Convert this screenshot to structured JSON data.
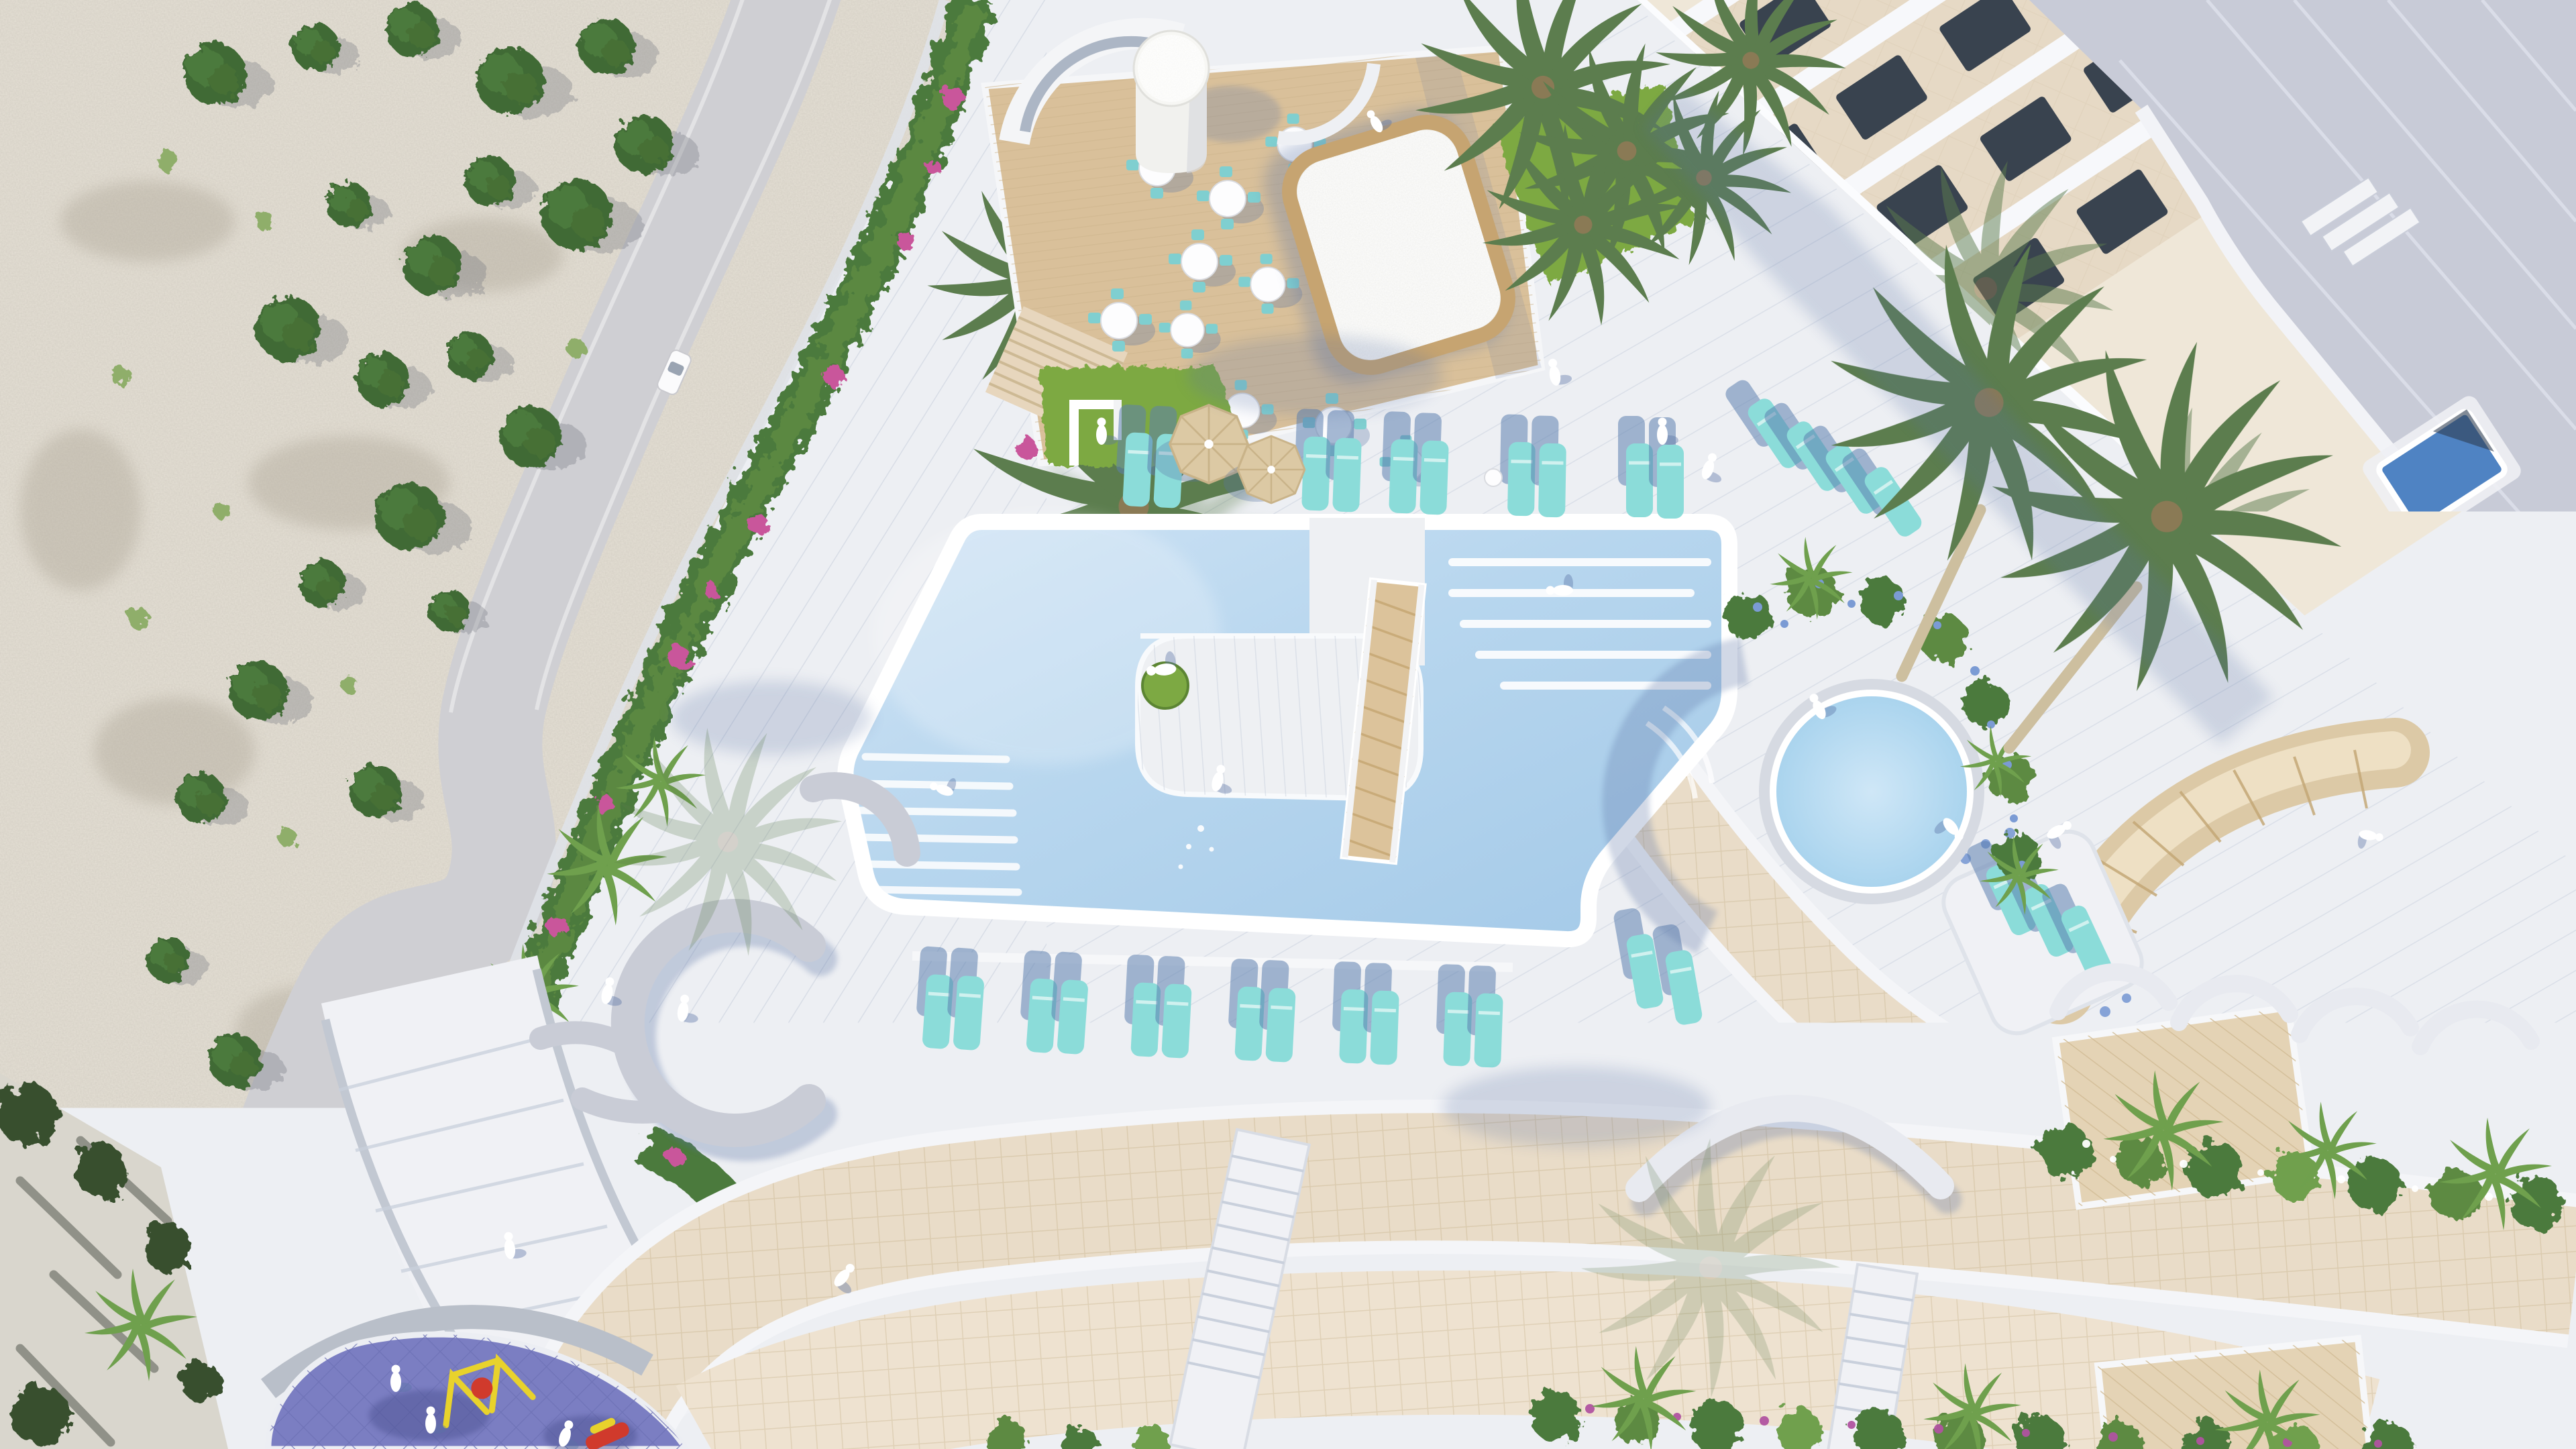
{
  "meta": {
    "title": "Top-down aerial architectural rendering of a seaside resort pool deck with cliff road, restaurant terrace, curved apartment building and playground",
    "view": "top-down aerial",
    "render_style": "architectural visualization, white Mediterranean style"
  },
  "palette": {
    "deck": "#edeff3",
    "deckStripe": "#c7cedc",
    "poolWater": "#b7d6ee",
    "poolDeep": "#a5cbe9",
    "roundPool": "#b9dcf2",
    "lounger": "#8bdcd9",
    "umbrella": "#dcc9a4",
    "wood": "#d9c09a",
    "woodDark": "#c6a471",
    "pavRoof": "#efefec",
    "grass": "#7da943",
    "tree": "#3f6b34",
    "treeLight": "#5d8a42",
    "palm": "#5c7d4e",
    "boug": "#c9579b",
    "blueFlower": "#7b9bd4",
    "rock": "#e5e0d5",
    "road": "#cfcfd3",
    "floor": "#e6d9c5",
    "window": "#39434f",
    "railing": "#f7f8fb",
    "roof": "#c8cbd7",
    "roofPool": "#4f83c3",
    "tan": "#e9dcc8",
    "tanLight": "#eee2d0",
    "playground": "#7b7ec2",
    "shore": "#6b6f66",
    "shadow": "#5a73a5",
    "people": "#ffffff",
    "bench": "#c9ccd6"
  },
  "labels": {
    "scene": "Aerial resort pool deck rendering",
    "cliff": "Rocky cliff hillside with round shrubs",
    "road": "Winding access road on the cliff",
    "car": "White car on the road",
    "hedge": "Landscaped hedge with bougainvillea along the deck edge",
    "terrace": "Restaurant terrace with round white tables and turquoise chairs",
    "pavilion": "Pool-bar pavilion with timber-edged roof",
    "cylinder": "White cylindrical rooftop tower",
    "pool": "Main free-form swimming pool",
    "island": "Pool island with circular lawn and timber slide ramp",
    "lanes": "Swim lane markings and submerged steps",
    "umbrellas": "Beige parasols",
    "loungersTop": "Row of turquoise sun loungers above the pool",
    "loungersBottom": "Row of turquoise sun loungers below the pool",
    "loungersSide": "Sun loungers on side platforms",
    "roundPool": "Round splash pool with planted border",
    "building": "Curved apartment building with stepped balcony terraces",
    "roof": "Flat rooftop with small rooftop pool",
    "canopy": "Rattan canopy at the building corner",
    "promenade": "Curved pedestrian promenade",
    "playground": "Purple rubber-surface children playground",
    "walkways": "Sand-coloured tiled walkways",
    "plantingBottom": "Planting strip with palms and purple flowers",
    "benches": "Curved white and grey benches",
    "shore": "Dark shoreline strip with trees",
    "people": "People enjoying the deck and pool"
  },
  "counts": {
    "pools": 3,
    "dining_tables": 10,
    "parasols": 2,
    "sun_loungers": 31,
    "curved_benches": 8,
    "palm_trees": 20,
    "round_shrubs": 24,
    "people": 16,
    "cars": 1
  }
}
